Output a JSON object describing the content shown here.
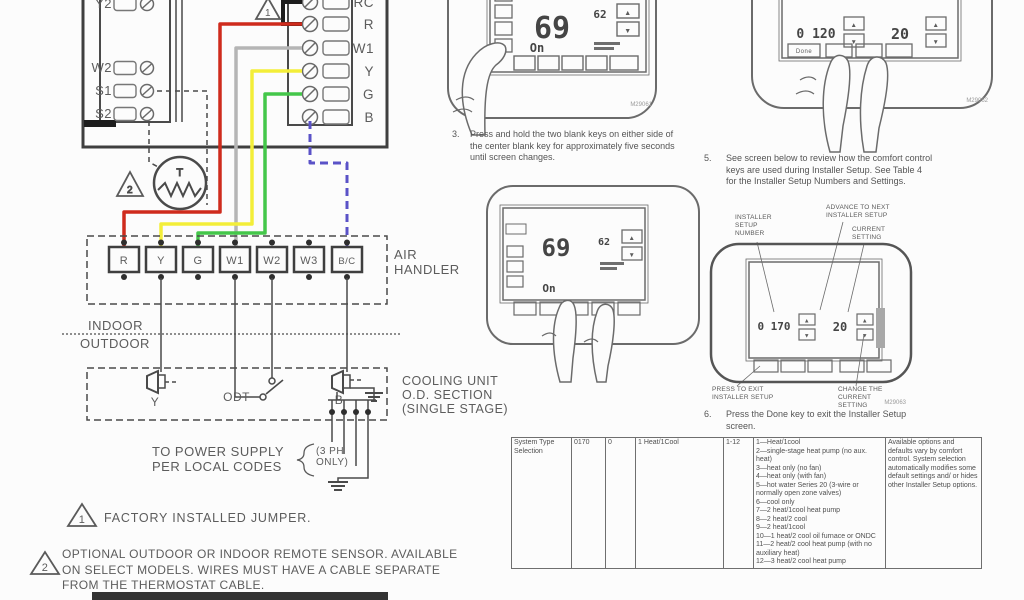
{
  "colors": {
    "wire_red": "#cf2b1d",
    "wire_yellow": "#f3ee39",
    "wire_green": "#44c74a",
    "wire_gray": "#b5b5b5",
    "wire_blue": "#5a52c7",
    "line": "#4a4a4a",
    "accent_black": "#1d1d1d"
  },
  "icons": {
    "up": "▲",
    "down": "▼"
  },
  "subbase": {
    "left_terminals": [
      "Y2",
      "W2",
      "S1",
      "S2"
    ],
    "right_terminals": [
      "RC",
      "R",
      "W1",
      "Y",
      "G",
      "B"
    ],
    "jumper_marker": "1",
    "sensor_label": "T",
    "sensor_marker": "2"
  },
  "air_handler": {
    "label": "AIR\nHANDLER",
    "terminals": [
      "R",
      "Y",
      "G",
      "W1",
      "W2",
      "W3",
      "B/C"
    ]
  },
  "zones": {
    "indoor": "INDOOR",
    "outdoor": "OUTDOOR"
  },
  "cooling_unit": {
    "label": "COOLING UNIT\nO.D. SECTION\n(SINGLE STAGE)",
    "y_label": "Y",
    "odt_label": "ODT",
    "b_label": "B"
  },
  "power": {
    "label": "TO POWER SUPPLY\nPER LOCAL CODES",
    "ph_note": "(3 PH\nONLY)"
  },
  "notes": [
    {
      "marker": "1",
      "text": "FACTORY INSTALLED JUMPER."
    },
    {
      "marker": "2",
      "text": "OPTIONAL OUTDOOR OR INDOOR REMOTE SENSOR.  AVAILABLE\nON SELECT MODELS.  WIRES MUST HAVE A CABLE SEPARATE\nFROM THE THERMOSTAT CABLE."
    }
  ],
  "steps": {
    "step3": {
      "num": "3.",
      "text": "Press and hold the two blank keys on either side of\nthe center blank key for approximately five seconds\nuntil screen changes."
    },
    "step5": {
      "num": "5.",
      "text": "See screen below to review how the comfort control\nkeys are used during Installer Setup. See Table 4\nfor the Installer Setup Numbers and Settings."
    },
    "step6": {
      "num": "6.",
      "text": "Press the Done key to exit the Installer Setup\nscreen."
    }
  },
  "thermostat1": {
    "temp": "69",
    "setpoint": "62",
    "mode": "On",
    "fig": "M29061"
  },
  "thermostat2": {
    "temp": "69",
    "setpoint": "62",
    "mode": "On"
  },
  "thermostat3": {
    "isu": "0 120",
    "setting": "20",
    "done_key": "Done",
    "fig": "M29062"
  },
  "thermostat4": {
    "isu": "0 170",
    "setting": "20",
    "fig": "M29063",
    "callouts": {
      "setup_number": "INSTALLER\nSETUP\nNUMBER",
      "advance": "ADVANCE TO NEXT\nINSTALLER SETUP",
      "current": "CURRENT\nSETTING",
      "exit": "PRESS TO EXIT\nINSTALLER SETUP",
      "change": "CHANGE THE\nCURRENT\nSETTING"
    }
  },
  "table": {
    "rows": [
      {
        "name": "System Type Selection",
        "setup_number": "0170",
        "col3": "0",
        "default": "1 Heat/1Cool",
        "range": "1-12",
        "options": [
          "1—Heat/1cool",
          "2—single-stage heat pump (no aux. heat)",
          "3—heat only (no fan)",
          "4—heat only (with fan)",
          "5—hot water Series 20 (3-wire or normally open zone valves)",
          "6—cool only",
          "7—2 heat/1cool heat pump",
          "8—2 heat/2 cool",
          "9—2 heat/1cool",
          "10—1 heat/2 cool oil furnace or ONDC",
          "11—2 heat/2 cool heat pump (with no auxiliary heat)",
          "12—3 heat/2 cool heat pump"
        ],
        "notes": "Available options and defaults vary by comfort control. System selection automatically modifies some default settings and/ or hides other Installer Setup options."
      }
    ]
  }
}
